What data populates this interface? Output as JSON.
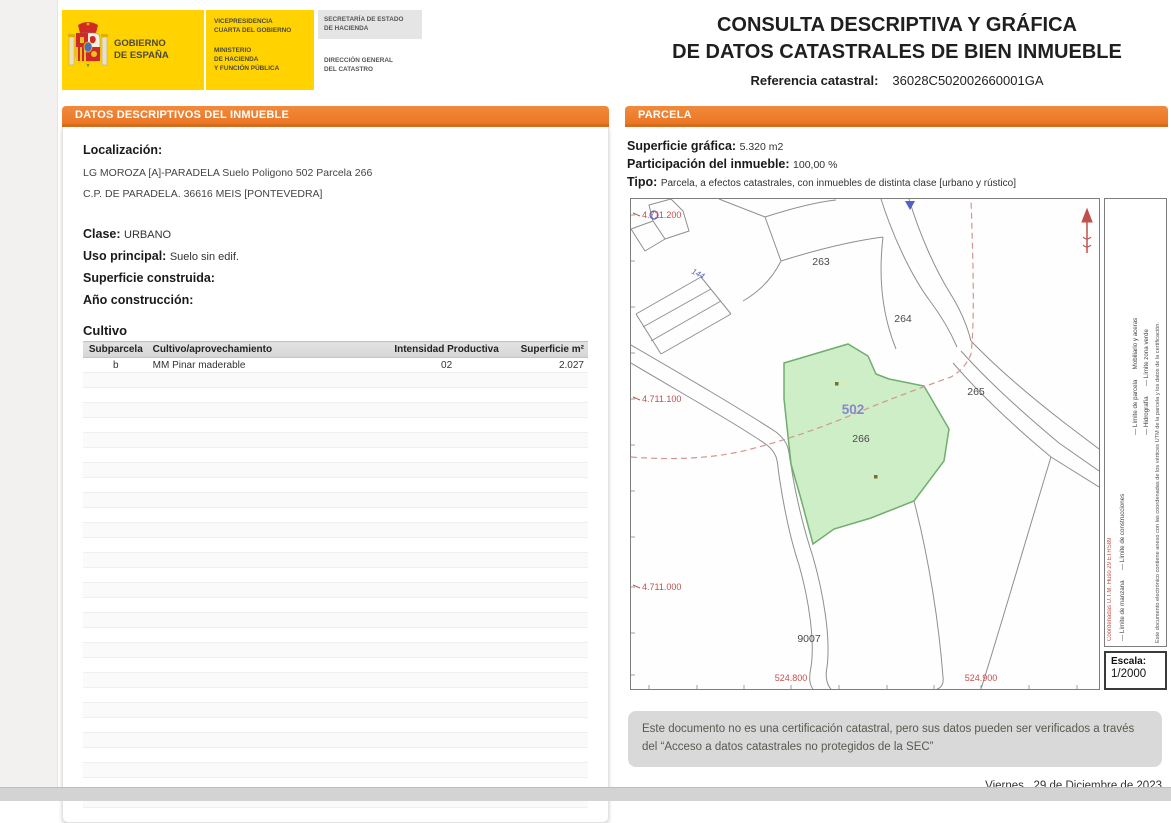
{
  "header": {
    "logo": {
      "gobierno_line1": "GOBIERNO",
      "gobierno_line2": "DE ESPAÑA",
      "vice_line1": "VICEPRESIDENCIA",
      "vice_line2": "CUARTA DEL GOBIERNO",
      "min_line1": "MINISTERIO",
      "min_line2": "DE HACIENDA",
      "min_line3": "Y FUNCIÓN PÚBLICA",
      "secretaria_line1": "SECRETARÍA DE ESTADO",
      "secretaria_line2": "DE HACIENDA",
      "direccion_line1": "DIRECCIÓN GENERAL",
      "direccion_line2": "DEL CATASTRO"
    },
    "title_line1": "CONSULTA DESCRIPTIVA Y GRÁFICA",
    "title_line2": "DE DATOS CATASTRALES DE BIEN INMUEBLE",
    "ref_label": "Referencia catastral:",
    "ref_value": "36028C502002660001GA"
  },
  "left_panel": {
    "header": "DATOS DESCRIPTIVOS DEL INMUEBLE",
    "localizacion_label": "Localización:",
    "localizacion_line1": "LG MOROZA [A]-PARADELA  Suelo Poligono 502 Parcela 266",
    "localizacion_line2": "C.P. DE PARADELA. 36616 MEIS [PONTEVEDRA]",
    "clase_label": "Clase:",
    "clase_value": "URBANO",
    "uso_label": "Uso principal:",
    "uso_value": "Suelo sin edif.",
    "superficie_label": "Superficie construida:",
    "superficie_value": "",
    "anio_label": "Año construcción:",
    "anio_value": "",
    "cultivo_title": "Cultivo",
    "table": {
      "headers": [
        "Subparcela",
        "Cultivo/aprovechamiento",
        "Intensidad Productiva",
        "Superficie m²"
      ],
      "rows": [
        [
          "b",
          "MM Pinar maderable",
          "02",
          "2.027"
        ]
      ],
      "empty_row_count": 29
    }
  },
  "right_panel": {
    "header": "PARCELA",
    "superficie_label": "Superficie gráfica:",
    "superficie_value": "5.320 m2",
    "participacion_label": "Participación del inmueble:",
    "participacion_value": "100,00 %",
    "tipo_label": "Tipo:",
    "tipo_value": "Parcela, a efectos catastrales, con inmuebles de distinta clase [urbano y rústico]",
    "map": {
      "coord_y_top": "4.711.200",
      "coord_y_mid": "4.711.100",
      "coord_y_bot": "4.711.000",
      "coord_x_left": "524.800",
      "coord_x_right": "524.900",
      "labels": {
        "p263": "263",
        "p264": "264",
        "p265": "265",
        "p266": "266",
        "p9007": "9007",
        "p502": "502",
        "road": "144"
      },
      "legend": {
        "crs": "Coordenadas U.T.M. Huso 29 ETRS89",
        "line_manzana": "— Límite de manzana      — Límite de construcciones",
        "line_parcela": "— Límite de parcela      Mobiliario y aceras",
        "line_hidro": "— Hidrografía      — Límite zona verde",
        "annex": "Este documento electrónico contiene anexo con las coordenadas de los vértices UTM de la parcela y los datos de la certificación."
      },
      "escala_label": "Escala:",
      "escala_value": "1/2000"
    },
    "disclaimer": "Este documento no es una certificación catastral, pero sus datos pueden ser verificados a través del “Acceso a datos catastrales no protegidos de la SEC”",
    "date": "Viernes , 29 de Diciembre de 2023"
  },
  "colors": {
    "accent_orange": "#ED7D31",
    "accent_orange_dark": "#D96C1A",
    "logo_yellow": "#FFD200",
    "highlight_green_fill": "#CDEEC6",
    "highlight_green_stroke": "#6FAE6F",
    "coord_red": "#C0504D",
    "polygon_label_purple": "#8D85CC",
    "disclaimer_gray": "#D9D9D9"
  }
}
